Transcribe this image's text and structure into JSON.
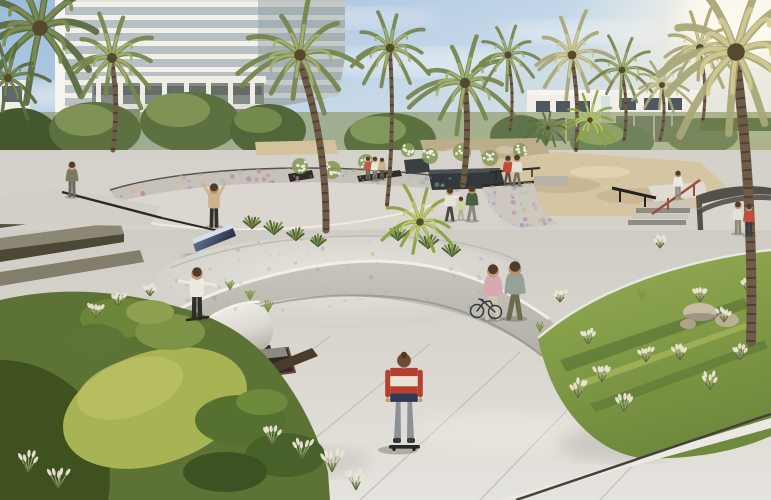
{
  "meta": {
    "kind": "architectural-rendering",
    "subject": "community skatepark plaza with palm trees, residential tower and white townhouses"
  },
  "palette": {
    "sky_top": "#9bbbdb",
    "sky_mid": "#c6d9e9",
    "sky_warm": "#f1e8d6",
    "sun_glow": "#fff5dd",
    "concrete_light": "#e3e1da",
    "concrete_mid": "#d4d1ca",
    "concrete_shadow": "#a9a69e",
    "skate_channel_blue": "#5b69a8",
    "channel_edge_blue": "#38417a",
    "lawn_bright": "#a8b454",
    "lawn_right": "#8fa84f",
    "foliage_dark": "#3f511f",
    "sand": "#d7c6a3",
    "corten_dark": "#3a332b",
    "townhouse_white": "#f1efe8",
    "rail_red": "#9a4f3b",
    "rail_black": "#24221f",
    "graffiti": [
      "#c4899f",
      "#87a1c9",
      "#d1ba80",
      "#9dbfb2",
      "#b08fae",
      "#a9a5b5"
    ]
  },
  "people": [
    {
      "name": "onlooker-at-bowl",
      "x": 72,
      "y": 196,
      "h": 34,
      "pose": "stand",
      "top": "#7a7a62",
      "pants": "#6b675c",
      "skin": "#caa582"
    },
    {
      "name": "skater-arms-raised-on-ledge",
      "x": 214,
      "y": 226,
      "h": 42,
      "pose": "armsup",
      "top": "#cdb28b",
      "pants": "#35322e",
      "skin": "#b98f6e"
    },
    {
      "name": "skater-grinding-ledge",
      "x": 197,
      "y": 318,
      "h": 50,
      "pose": "armsout",
      "top": "#ece9e0",
      "pants": "#2f2d2b",
      "skin": "#c29a76",
      "board": true
    },
    {
      "name": "mother-holding-hands",
      "x": 450,
      "y": 220,
      "h": 32,
      "pose": "walk",
      "top": "#e7e3da",
      "pants": "#4a4742",
      "skin": "#c59b78"
    },
    {
      "name": "child-holding-hands",
      "x": 461,
      "y": 219,
      "h": 22,
      "pose": "walk",
      "top": "#c9d6a2",
      "pants": "#b9ab90",
      "skin": "#c59b78"
    },
    {
      "name": "father-holding-hands",
      "x": 472,
      "y": 220,
      "h": 34,
      "pose": "walk",
      "top": "#49603f",
      "pants": "#8d877a",
      "skin": "#b98f6e"
    },
    {
      "name": "woman-walking-couple",
      "x": 508,
      "y": 184,
      "h": 28,
      "pose": "walk",
      "top": "#c14b38",
      "pants": "#5a564e",
      "skin": "#c59b78"
    },
    {
      "name": "man-walking-couple",
      "x": 517,
      "y": 185,
      "h": 30,
      "pose": "walk",
      "top": "#e3e0d6",
      "pants": "#77725f",
      "skin": "#b98f6e"
    },
    {
      "name": "woman-pushing-bicycle",
      "x": 493,
      "y": 318,
      "h": 53,
      "pose": "walk",
      "top": "#d9a9b2",
      "pants": "#cfc5b4",
      "skin": "#c79d79"
    },
    {
      "name": "man-with-skateboard",
      "x": 515,
      "y": 318,
      "h": 56,
      "pose": "walk",
      "top": "#98a198",
      "pants": "#6e6b51",
      "skin": "#b98f6e"
    },
    {
      "name": "skater-by-stairs",
      "x": 678,
      "y": 198,
      "h": 27,
      "pose": "stand",
      "top": "#eceade",
      "pants": "#8e8c84",
      "skin": "#b98f6e"
    },
    {
      "name": "onlooker-white-top-on-bank",
      "x": 738,
      "y": 233,
      "h": 31,
      "pose": "stand",
      "top": "#e0e1d7",
      "pants": "#8a8678",
      "skin": "#c59b78"
    },
    {
      "name": "onlooker-red-top-on-bank",
      "x": 749,
      "y": 235,
      "h": 31,
      "pose": "stand",
      "top": "#bf4e3c",
      "pants": "#3d3d45",
      "skin": "#c59b78"
    },
    {
      "name": "visitor-group-1",
      "x": 368,
      "y": 179,
      "h": 22,
      "pose": "stand",
      "top": "#bf5a43",
      "pants": "#6b675c",
      "skin": "#c59b78"
    },
    {
      "name": "visitor-group-2",
      "x": 375,
      "y": 180,
      "h": 23,
      "pose": "stand",
      "top": "#e8e5da",
      "pants": "#7a7668",
      "skin": "#c59b78"
    },
    {
      "name": "visitor-group-3",
      "x": 382,
      "y": 179,
      "h": 21,
      "pose": "stand",
      "top": "#c8b489",
      "pants": "#55514a",
      "skin": "#b98f6e"
    }
  ],
  "hero_skater": {
    "name": "skateboarder-striped-shirt",
    "x": 404,
    "y": 447,
    "h": 92,
    "stripes": [
      "#b5402e",
      "#e9e2d2",
      "#b5402e",
      "#2e3a56"
    ],
    "pants": "#8d9298",
    "hair": "#6d4b32",
    "shoes": "#3a3734",
    "board": "#2a2724",
    "skin": "#c79d79"
  },
  "bicycle": {
    "name": "bicycle",
    "x": 477,
    "y": 311,
    "wheel_r": 6.5,
    "color": "#34383c"
  },
  "palms": [
    {
      "name": "palm-top-left-corner",
      "cx": 40,
      "cy": 28,
      "s": 78,
      "tone": "dark"
    },
    {
      "name": "palm-top-left-small",
      "cx": 8,
      "cy": 78,
      "s": 40,
      "tone": "dark"
    },
    {
      "name": "palm-left-behind-building",
      "cx": 112,
      "cy": 58,
      "s": 50,
      "tone": "olive",
      "base": [
        113,
        150
      ],
      "tw": 5
    },
    {
      "name": "palm-center-left-tall",
      "cx": 300,
      "cy": 55,
      "s": 58,
      "tone": "olive",
      "base": [
        326,
        230
      ],
      "tw": 7,
      "bow": 14
    },
    {
      "name": "palm-center-slim",
      "cx": 390,
      "cy": 48,
      "s": 44,
      "tone": "olive",
      "base": [
        387,
        205
      ],
      "tw": 4
    },
    {
      "name": "palm-center-planter",
      "cx": 465,
      "cy": 83,
      "s": 52,
      "tone": "olive",
      "base": [
        463,
        185
      ],
      "tw": 6
    },
    {
      "name": "palm-mid-right",
      "cx": 508,
      "cy": 55,
      "s": 36,
      "tone": "olive",
      "base": [
        510,
        130
      ],
      "tw": 3
    },
    {
      "name": "palm-right-b",
      "cx": 572,
      "cy": 55,
      "s": 44,
      "tone": "sunlit",
      "base": [
        576,
        150
      ],
      "tw": 4
    },
    {
      "name": "palm-right-c",
      "cx": 622,
      "cy": 70,
      "s": 34,
      "tone": "olive",
      "base": [
        624,
        140
      ],
      "tw": 3
    },
    {
      "name": "palm-right-d",
      "cx": 662,
      "cy": 85,
      "s": 30,
      "tone": "sunlit",
      "base": [
        660,
        140
      ],
      "tw": 3
    },
    {
      "name": "palm-right-e",
      "cx": 700,
      "cy": 48,
      "s": 40,
      "tone": "sunlit",
      "base": [
        703,
        120
      ],
      "tw": 3
    },
    {
      "name": "palm-corner-right",
      "cx": 736,
      "cy": 52,
      "s": 88,
      "tone": "sunlit",
      "base": [
        751,
        342
      ],
      "tw": 10,
      "bow": 10
    },
    {
      "name": "palmetto-foreground-bed",
      "cx": 420,
      "cy": 222,
      "s": 38,
      "tone": "bright"
    },
    {
      "name": "palmetto-townhouse-a",
      "cx": 590,
      "cy": 120,
      "s": 28,
      "tone": "bright"
    },
    {
      "name": "palmetto-townhouse-b",
      "cx": 548,
      "cy": 128,
      "s": 22,
      "tone": "dark"
    }
  ],
  "plants": [
    {
      "type": "plume",
      "x": 302,
      "y": 458,
      "s": 16
    },
    {
      "type": "plume",
      "x": 332,
      "y": 472,
      "s": 18
    },
    {
      "type": "plume",
      "x": 356,
      "y": 490,
      "s": 16
    },
    {
      "type": "plume",
      "x": 272,
      "y": 444,
      "s": 14
    },
    {
      "type": "plume",
      "x": 28,
      "y": 472,
      "s": 16
    },
    {
      "type": "plume",
      "x": 58,
      "y": 488,
      "s": 16
    },
    {
      "type": "plume",
      "x": 96,
      "y": 318,
      "s": 12
    },
    {
      "type": "plume",
      "x": 118,
      "y": 306,
      "s": 11
    },
    {
      "type": "plume",
      "x": 150,
      "y": 296,
      "s": 10
    },
    {
      "type": "plume",
      "x": 578,
      "y": 398,
      "s": 15
    },
    {
      "type": "plume",
      "x": 602,
      "y": 382,
      "s": 14
    },
    {
      "type": "plume",
      "x": 624,
      "y": 412,
      "s": 15
    },
    {
      "type": "plume",
      "x": 646,
      "y": 362,
      "s": 12
    },
    {
      "type": "plume",
      "x": 700,
      "y": 302,
      "s": 12
    },
    {
      "type": "plume",
      "x": 724,
      "y": 322,
      "s": 12
    },
    {
      "type": "plume",
      "x": 748,
      "y": 292,
      "s": 11
    },
    {
      "type": "plume",
      "x": 660,
      "y": 248,
      "s": 10
    },
    {
      "type": "plume",
      "x": 560,
      "y": 302,
      "s": 10
    },
    {
      "type": "plume",
      "x": 588,
      "y": 344,
      "s": 12
    },
    {
      "type": "plume",
      "x": 680,
      "y": 360,
      "s": 13
    },
    {
      "type": "plume",
      "x": 710,
      "y": 390,
      "s": 14
    },
    {
      "type": "plume",
      "x": 740,
      "y": 360,
      "s": 12
    },
    {
      "type": "agave",
      "x": 252,
      "y": 228,
      "s": 12
    },
    {
      "type": "agave",
      "x": 274,
      "y": 234,
      "s": 13
    },
    {
      "type": "agave",
      "x": 296,
      "y": 240,
      "s": 12
    },
    {
      "type": "agave",
      "x": 398,
      "y": 240,
      "s": 14
    },
    {
      "type": "agave",
      "x": 428,
      "y": 248,
      "s": 14
    },
    {
      "type": "agave",
      "x": 452,
      "y": 256,
      "s": 12
    },
    {
      "type": "agave",
      "x": 318,
      "y": 246,
      "s": 11
    },
    {
      "type": "whitebush",
      "x": 300,
      "y": 166,
      "s": 8
    },
    {
      "type": "whitebush",
      "x": 332,
      "y": 170,
      "s": 9
    },
    {
      "type": "whitebush",
      "x": 366,
      "y": 162,
      "s": 8
    },
    {
      "type": "whitebush",
      "x": 430,
      "y": 156,
      "s": 8
    },
    {
      "type": "whitebush",
      "x": 462,
      "y": 152,
      "s": 9
    },
    {
      "type": "whitebush",
      "x": 490,
      "y": 158,
      "s": 8
    },
    {
      "type": "whitebush",
      "x": 408,
      "y": 150,
      "s": 7
    },
    {
      "type": "whitebush",
      "x": 520,
      "y": 150,
      "s": 7
    },
    {
      "type": "grassgreen",
      "x": 250,
      "y": 300,
      "s": 12
    },
    {
      "type": "grassgreen",
      "x": 268,
      "y": 312,
      "s": 12
    },
    {
      "type": "grassgreen",
      "x": 230,
      "y": 290,
      "s": 10
    },
    {
      "type": "grassgreen",
      "x": 540,
      "y": 332,
      "s": 10
    },
    {
      "type": "grassgreen",
      "x": 642,
      "y": 300,
      "s": 11
    }
  ],
  "speckle_regions": [
    {
      "name": "bowl-graffiti",
      "clip": "cpBowl",
      "x": 112,
      "y": 164,
      "w": 346,
      "h": 40,
      "n": 170,
      "rmax": 2.2,
      "op": 0.85
    },
    {
      "name": "quarterpipe-graffiti",
      "clip": "cpQP",
      "x": 482,
      "y": 180,
      "w": 80,
      "h": 50,
      "n": 70,
      "rmax": 2.0,
      "op": 0.85
    },
    {
      "name": "foreground-basin-texture",
      "clip": "cpBasin",
      "x": 170,
      "y": 240,
      "w": 350,
      "h": 70,
      "n": 80,
      "rmax": 1.6,
      "op": 0.5
    }
  ]
}
